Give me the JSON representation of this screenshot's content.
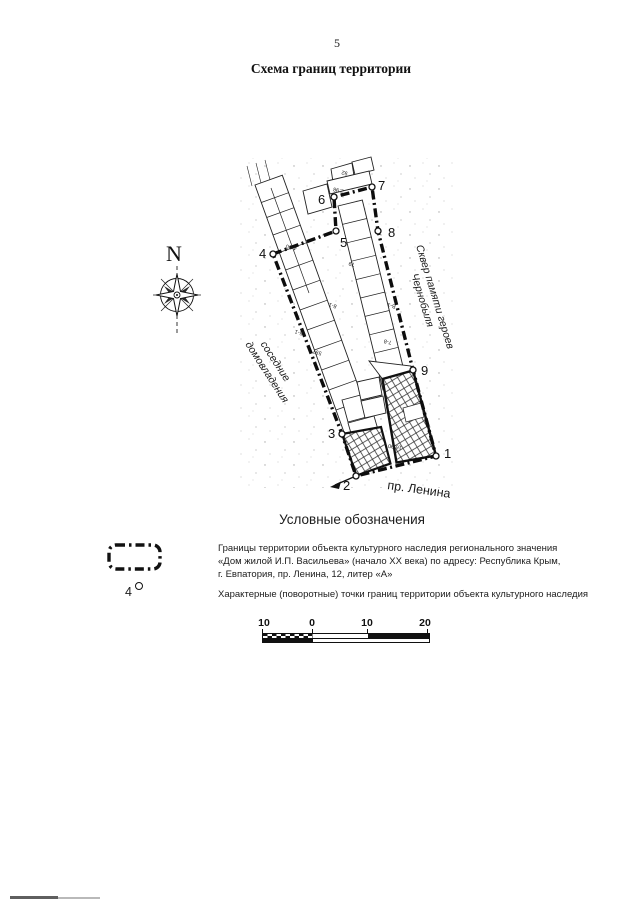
{
  "page": {
    "number": "5",
    "title": "Схема границ территории"
  },
  "map": {
    "compass": {
      "label": "N"
    },
    "labels": {
      "park_line1": "Сквер памяти героев",
      "park_line2": "Чернобыля",
      "neighbors_line1": "соседние",
      "neighbors_line2": "домовладения",
      "street": "пр. Ленина"
    },
    "points": [
      {
        "label": "1"
      },
      {
        "label": "2"
      },
      {
        "label": "3"
      },
      {
        "label": "4"
      },
      {
        "label": "5"
      },
      {
        "label": "6"
      },
      {
        "label": "7"
      },
      {
        "label": "8"
      },
      {
        "label": "9"
      }
    ],
    "annotations": [
      {
        "text": "4-90"
      },
      {
        "text": "5-1"
      },
      {
        "text": "В-1"
      },
      {
        "text": "79"
      },
      {
        "text": "597"
      },
      {
        "text": "7-8"
      },
      {
        "text": "8-1"
      },
      {
        "text": "16.90"
      },
      {
        "text": "92"
      },
      {
        "text": "2.98"
      }
    ]
  },
  "legend": {
    "title": "Условные обозначения",
    "items": [
      {
        "type": "boundary",
        "lines": [
          "Границы территории объекта культурного наследия регионального значения",
          "«Дом жилой И.П. Васильева» (начало XX века) по адресу: Республика Крым,",
          "г. Евпатория, пр. Ленина, 12, литер «А»"
        ]
      },
      {
        "type": "points",
        "symbol_number": "4",
        "lines": [
          "Характерные (поворотные) точки границ территории объекта культурного наследия"
        ]
      }
    ]
  },
  "scale_bar": {
    "labels": [
      "10",
      "0",
      "10",
      "20"
    ]
  }
}
